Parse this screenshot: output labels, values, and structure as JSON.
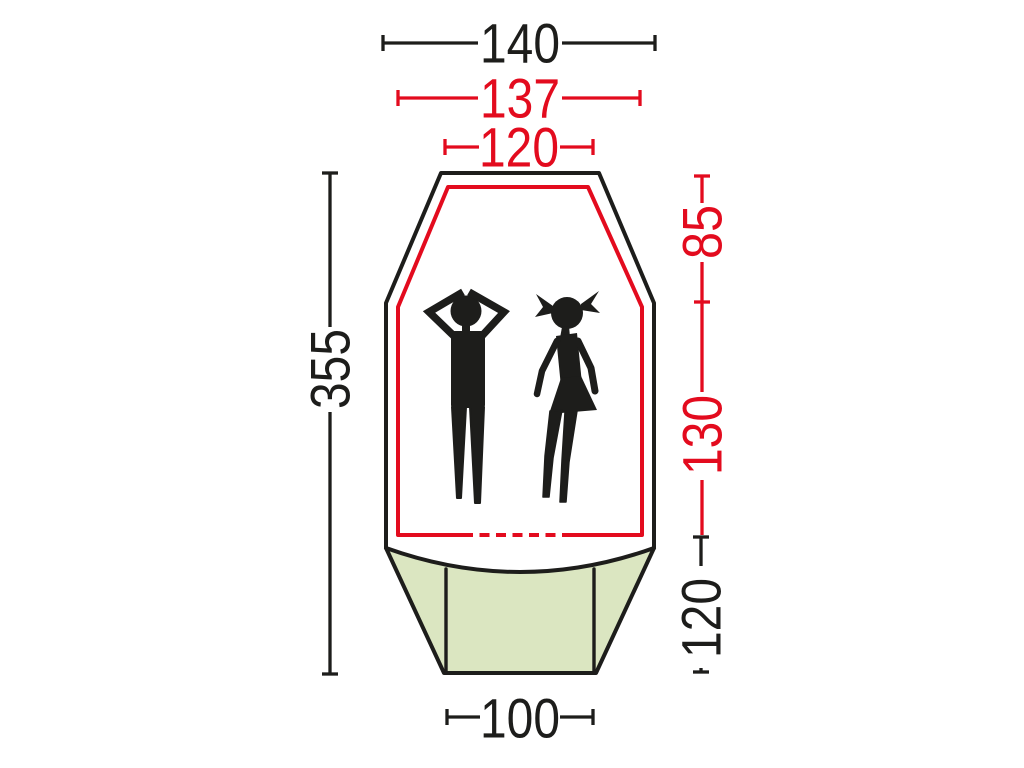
{
  "diagram": {
    "subject": "tent-floorplan-top-view",
    "colors": {
      "black": "#1d1d1b",
      "red": "#e30b1e",
      "vestibule_green": "#dbe6c1",
      "background": "#ffffff"
    },
    "dimensions": {
      "top_outer_width": {
        "value": "140",
        "color_role": "black"
      },
      "top_fly_width": {
        "value": "137",
        "color_role": "red"
      },
      "top_inner_width": {
        "value": "120",
        "color_role": "red"
      },
      "left_total_length": {
        "value": "355",
        "color_role": "black"
      },
      "right_inner_upper_length": {
        "value": "85",
        "color_role": "red"
      },
      "right_inner_lower_length": {
        "value": "130",
        "color_role": "red"
      },
      "right_vestibule_length": {
        "value": "120",
        "color_role": "black"
      },
      "bottom_vestibule_width": {
        "value": "100",
        "color_role": "black"
      }
    },
    "icons": {
      "man": "man-lying-pictogram",
      "girl": "girl-lying-pictogram"
    }
  }
}
